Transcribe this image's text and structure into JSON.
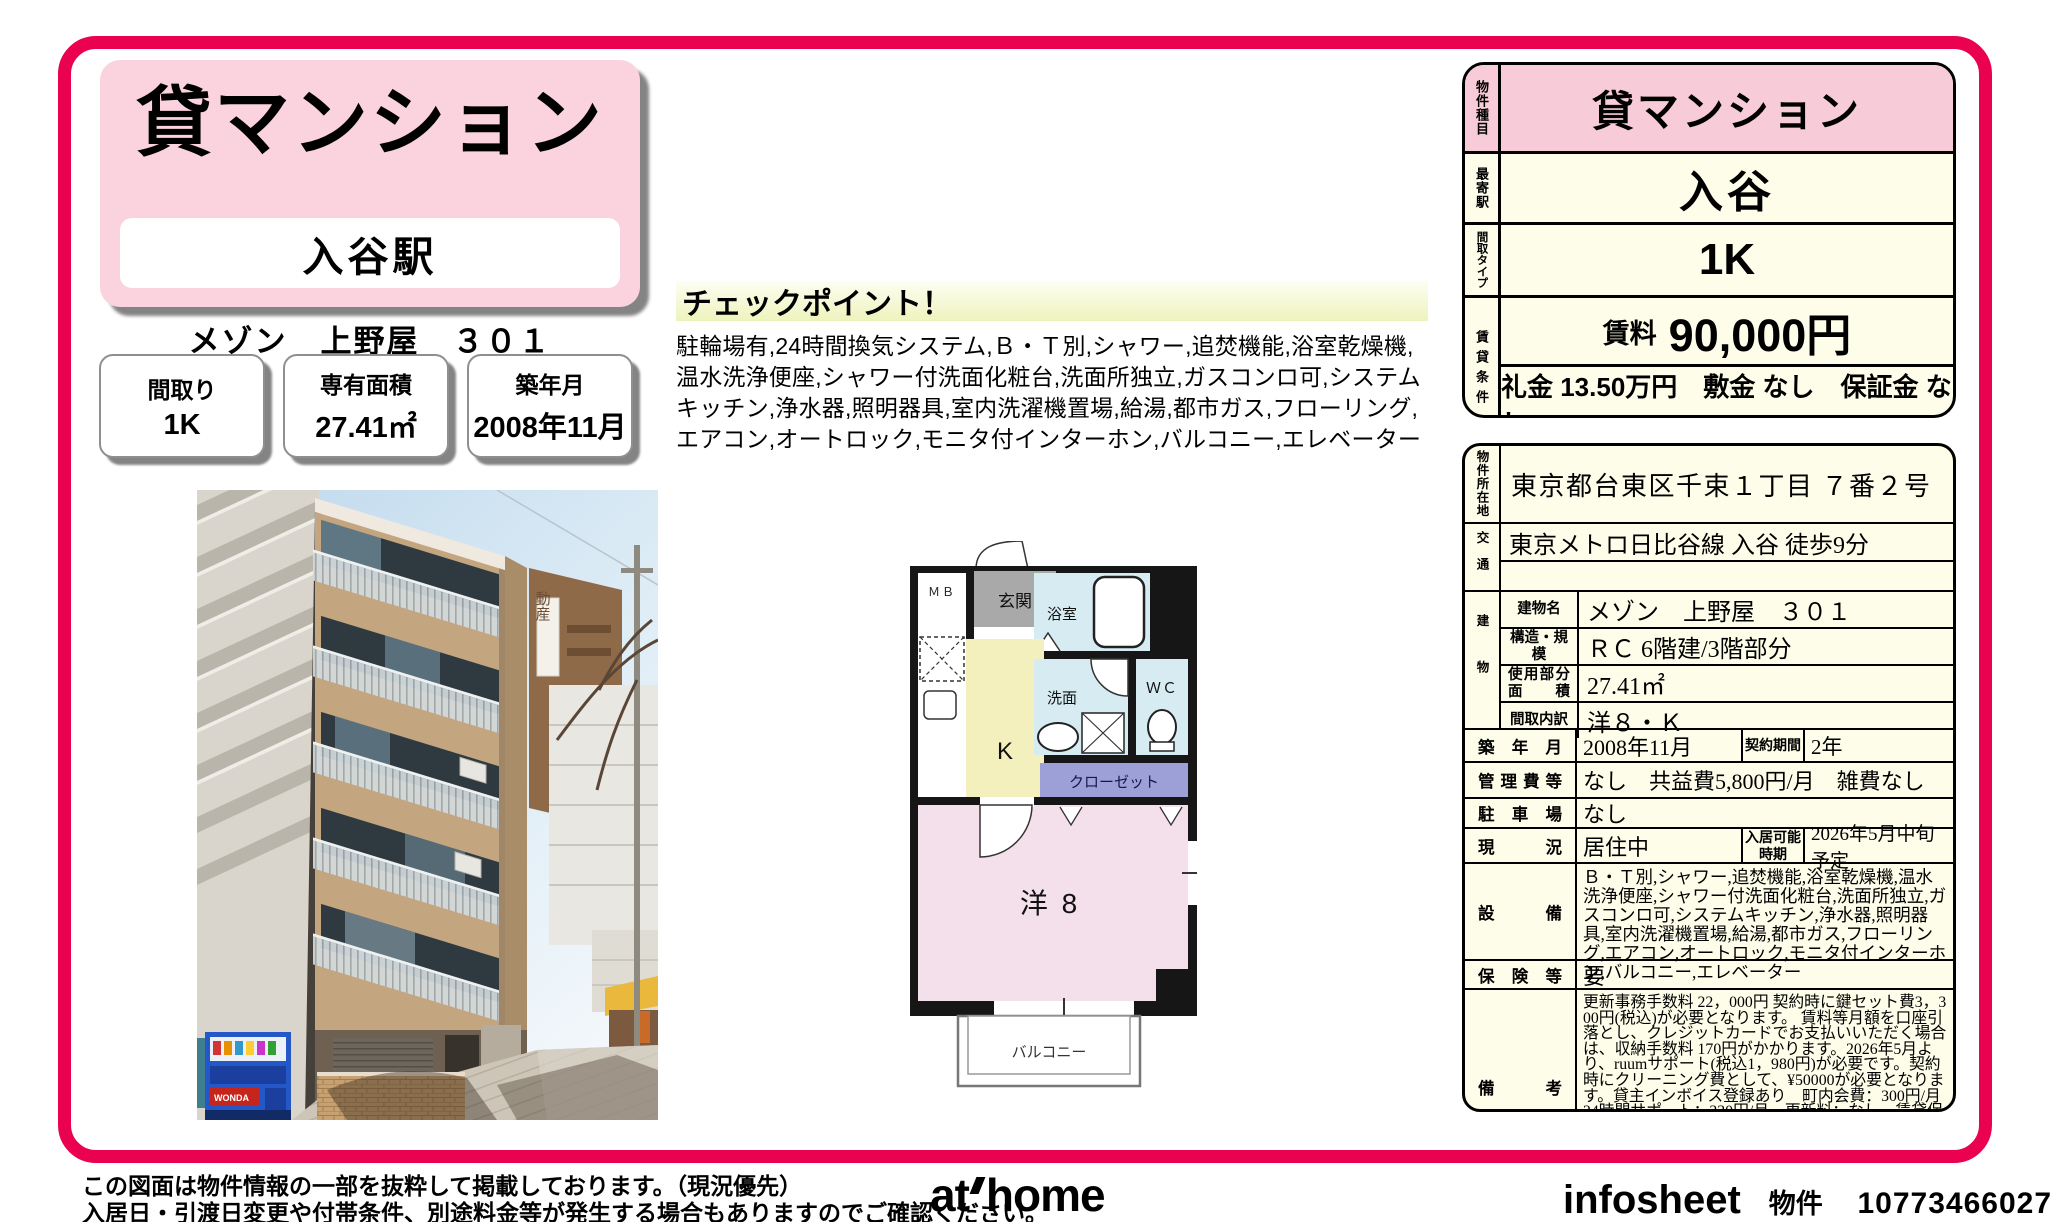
{
  "header": {
    "property_type": "貸マンション",
    "station_box": "入谷駅",
    "building_title": "メゾン　上野屋　３０１"
  },
  "summary_boxes": [
    {
      "label": "間取り",
      "value": "1K"
    },
    {
      "label": "専有面積",
      "value": "27.41㎡"
    },
    {
      "label": "築年月",
      "value": "2008年11月"
    }
  ],
  "checkpoint": {
    "title": "チェックポイント！",
    "body": "駐輪場有,24時間換気システム,Ｂ・Ｔ別,シャワー,追焚機能,浴室乾燥機,温水洗浄便座,シャワー付洗面化粧台,洗面所独立,ガスコンロ可,システムキッチン,浄水器,照明器具,室内洗濯機置場,給湯,都市ガス,フローリング,エアコン,オートロック,モニタ付インターホン,バルコニー,エレベーター"
  },
  "top_table": {
    "type_label": "物件種目",
    "type_value": "貸マンション",
    "station_label": "最寄駅",
    "station_value": "入谷",
    "plan_label": "間取タイプ",
    "plan_value": "1K",
    "cond_label": "賃貸条件",
    "rent_label": "賃料",
    "rent_value": "90,000円",
    "cond_sub": "礼金 13.50万円　敷金 なし　保証金 なし"
  },
  "detail_table": {
    "address": {
      "label": "物件所在地",
      "value": "東京都台東区千束１丁目 ７番２号"
    },
    "access": {
      "label": "交通",
      "value": "東京メトロ日比谷線 入谷 徒歩9分"
    },
    "building": {
      "label": "建物",
      "rows": [
        {
          "label": "建物名",
          "value": "メゾン　上野屋　３０１"
        },
        {
          "label": "構造・規模",
          "value": "ＲＣ 6階建/3階部分"
        },
        {
          "label": "使用部分",
          "label2": "面積",
          "value": "27.41㎡"
        },
        {
          "label": "間取内訳",
          "value": "洋８・Ｋ"
        }
      ]
    },
    "rows": [
      {
        "label": "築年月",
        "value": "2008年11月",
        "label2": "契約期間",
        "value2": "2年"
      },
      {
        "label": "管理費等",
        "value": "なし　共益費5,800円/月　雑費なし"
      },
      {
        "label": "駐車場",
        "value": "なし"
      },
      {
        "label": "現況",
        "value": "居住中",
        "label2": "入居可能時期",
        "value2": "2026年5月中旬予定"
      },
      {
        "label": "設備",
        "value": "Ｂ・Ｔ別,シャワー,追焚機能,浴室乾燥機,温水洗浄便座,シャワー付洗面化粧台,洗面所独立,ガスコンロ可,システムキッチン,浄水器,照明器具,室内洗濯機置場,給湯,都市ガス,フローリング,エアコン,オートロック,モニタ付インターホン,バルコニー,エレベーター"
      },
      {
        "label": "保険等",
        "value": "要"
      },
      {
        "label": "備考",
        "value": "更新事務手数料 22，000円 契約時に鍵セット費3，300円(税込)が必要となります。 賃料等月額を口座引落とし、クレジットカードでお支払いいただく場合は、収納手数料 170円がかかります。2026年5月より、ruumサポート(税込1，980円)が必要です。契約時にクリーニング費として、¥50000が必要となります。貸主インボイス登録あり　町内会費：300円/月　24時間サポート：330円/月　更新料：なし　賃貸保証：加入要 契約時保証委託料：2.2万/月額保証委託料：賃料総額の2.2％又は5.5％ ※ペット可は2.5万/2.5％　利用駅１：つくばエクスプレス 浅草 徒歩5分　利用駅２：東京メトロ銀座線 田原町 徒歩12分"
      }
    ]
  },
  "floorplan": {
    "mb": "ＭＢ",
    "genkan": "玄関",
    "bath": "浴室",
    "kitchen": "K",
    "wash": "洗面",
    "wc": "ＷＣ",
    "closet": "クローゼット",
    "room": "洋 8",
    "balcony": "バルコニー"
  },
  "photo": {
    "sign_text": "動産",
    "vending_text": "WONDA"
  },
  "footer": {
    "note1": "この図面は物件情報の一部を抜粋して掲載しております。（現況優先）",
    "note2": "入居日・引渡日変更や付帯条件、別途料金等が発生する場合もありますのでご確認ください。",
    "logo_at": "at",
    "logo_home": "home",
    "infosheet": "infosheet",
    "property_no_label": "物件番号",
    "property_no": "10773466027"
  },
  "colors": {
    "accent_frame": "#ea0150",
    "header_pink": "#fbd3de",
    "table_pink": "#f8cbd9",
    "table_cream": "#fdfde9",
    "checkpoint_yellow": "#eef3bd",
    "plan_bath_blue": "#d6ecf2",
    "plan_kitchen_yellow": "#f3f0bd",
    "plan_room_pink": "#f4e0ea",
    "plan_closet_purple": "#9da0d6"
  }
}
